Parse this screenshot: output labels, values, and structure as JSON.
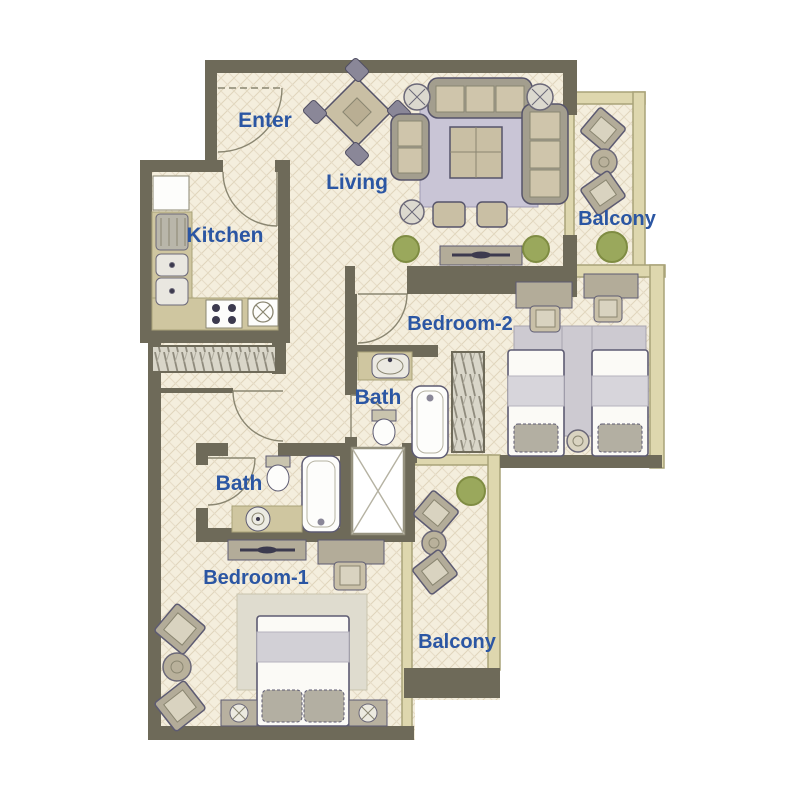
{
  "title": "Apartment floor plan",
  "rooms": [
    {
      "name": "enter",
      "label": "Enter"
    },
    {
      "name": "living",
      "label": "Living"
    },
    {
      "name": "kitchen",
      "label": "Kitchen"
    },
    {
      "name": "balcony-top",
      "label": "Balcony"
    },
    {
      "name": "bedroom-2",
      "label": "Bedroom-2"
    },
    {
      "name": "bath-2",
      "label": "Bath"
    },
    {
      "name": "bath-1",
      "label": "Bath"
    },
    {
      "name": "bedroom-1",
      "label": "Bedroom-1"
    },
    {
      "name": "balcony-bottom",
      "label": "Balcony"
    }
  ],
  "colors": {
    "wall": "#6e6a59",
    "floor": "#f4eedd",
    "lattice_line": "#e0d5bc",
    "rail_fill": "#ded7ae",
    "rail_stroke": "#a9a379",
    "counter": "#cfc6a0",
    "label_text": "#2b56a3",
    "rug_living": "#c9c5d6",
    "rug_bedroom": "#dfdccf",
    "plant": "#9aa85c",
    "furniture_outline": "#5d5b72",
    "furniture_fill": "#c9bfa4",
    "frame_gray": "#a39e8e",
    "bed_white": "#fbfaf6",
    "blanket_gray": "#d7d5db",
    "pillow_gray": "#b3afa2"
  },
  "icons": {
    "dining-table-icon": "rotated square with 4 chairs",
    "sofa-icon": "rounded rect with cushions",
    "coffee-table-icon": "square with cross",
    "side-table-icon": "circle with petals",
    "tv-console-icon": "bar with lens",
    "plant-icon": "green circle",
    "fridge-icon": "white box",
    "stove-icon": "white box with 4 burners",
    "kitchen-sink-icon": "rounded box with drain dot",
    "prep-sink-icon": "circle with X",
    "wardrobe-icon": "hatched rectangle",
    "twin-bed-icon": "bed with pillow",
    "double-bed-icon": "bed with two pillows",
    "desk-icon": "rectangle with chair",
    "toilet-icon": "tank and bowl",
    "washbasin-icon": "oval basin",
    "bathtub-icon": "rounded tub",
    "shaft-icon": "white box with X diagonals",
    "balcony-chair-icon": "tilted square chair",
    "door-icon": "quarter-circle swing arc"
  }
}
